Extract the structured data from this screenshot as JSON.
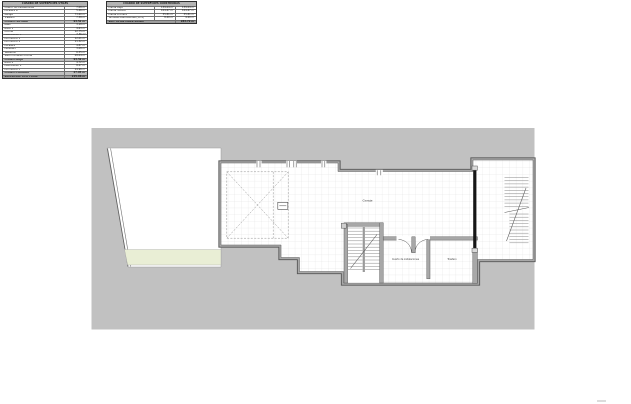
{
  "tables": {
    "left": {
      "title": "CUADRO DE SUPERFICIES ÚTILES",
      "rows": [
        {
          "label": "Cuarto de instalaciones",
          "value": "7.08 m²",
          "type": "item"
        },
        {
          "label": "Escalera B",
          "value": "5.46 m²",
          "type": "item"
        },
        {
          "label": "Garaje",
          "value": "73.60 m²",
          "type": "item"
        },
        {
          "label": "Trastero",
          "value": "7.38 m²",
          "type": "item"
        },
        {
          "label": "PLANTA SÓTANO",
          "value": "93.52 m²",
          "type": "subtotal"
        },
        {
          "label": "Aseo",
          "value": "3.18 m²",
          "type": "item"
        },
        {
          "label": "Baño 1",
          "value": "4.63 m²",
          "type": "item"
        },
        {
          "label": "Cocina",
          "value": "12.75 m²",
          "type": "item"
        },
        {
          "label": "Distribuidor 1",
          "value": "7.36 m²",
          "type": "item"
        },
        {
          "label": "Dormitorio 1",
          "value": "12.01 m²",
          "type": "item"
        },
        {
          "label": "Dormitorio 2",
          "value": "11.32 m²",
          "type": "item"
        },
        {
          "label": "Escalera",
          "value": "4.87 m²",
          "type": "item"
        },
        {
          "label": "Lavadero",
          "value": "3.08 m²",
          "type": "item"
        },
        {
          "label": "Vestíbulo",
          "value": "6.35 m²",
          "type": "item"
        },
        {
          "label": "Salón comedor-cocina",
          "value": "28.04 m²",
          "type": "item"
        },
        {
          "label": "PLANTA BAJA",
          "value": "93.59 m²",
          "type": "subtotal"
        },
        {
          "label": "Baño 2",
          "value": "4.72 m²",
          "type": "item"
        },
        {
          "label": "Distribuidor 2",
          "value": "8.27 m²",
          "type": "item"
        },
        {
          "label": "Dormitorio 3",
          "value": "14.96 m²",
          "type": "item"
        },
        {
          "label": "PLANTA PRIMERA",
          "value": "27.95 m²",
          "type": "subtotal"
        },
        {
          "label": "SUPERFICIE ÚTIL TOTAL",
          "value": "215.06 m²",
          "type": "total"
        }
      ]
    },
    "right": {
      "title": "CUADRO DE SUPERFICIES CONSTRUIDAS",
      "rows": [
        {
          "label": "Planta Baja",
          "v1": "139.04 m²",
          "v2": "139.04 m²",
          "type": "item"
        },
        {
          "label": "Planta Sótano",
          "v1": "104.67 m²",
          "v2": "104.67 m²",
          "type": "item"
        },
        {
          "label": "Planta Primera",
          "v1": "35.81 m²",
          "v2": "35.81 m²",
          "type": "item"
        },
        {
          "label": "Terrazas descubiertas (50%)",
          "v1": "8.40 m²",
          "v2": "4.20 m²",
          "type": "item"
        },
        {
          "label": "SUP. TOTAL CONSTRUIDA",
          "v1": "",
          "v2": "283.72 m²",
          "type": "total"
        }
      ]
    }
  },
  "plan": {
    "labels": {
      "garage": "Garaje",
      "utility_room": "Cuarto de instalaciones",
      "storage_room": "Trastero"
    },
    "colors": {
      "bg": "#c1c1c1",
      "wall": "#a8a8a8",
      "edge": "#565656",
      "tile": "#dedede",
      "terrace": "#e9eed5",
      "black_wall": "#161616"
    }
  }
}
